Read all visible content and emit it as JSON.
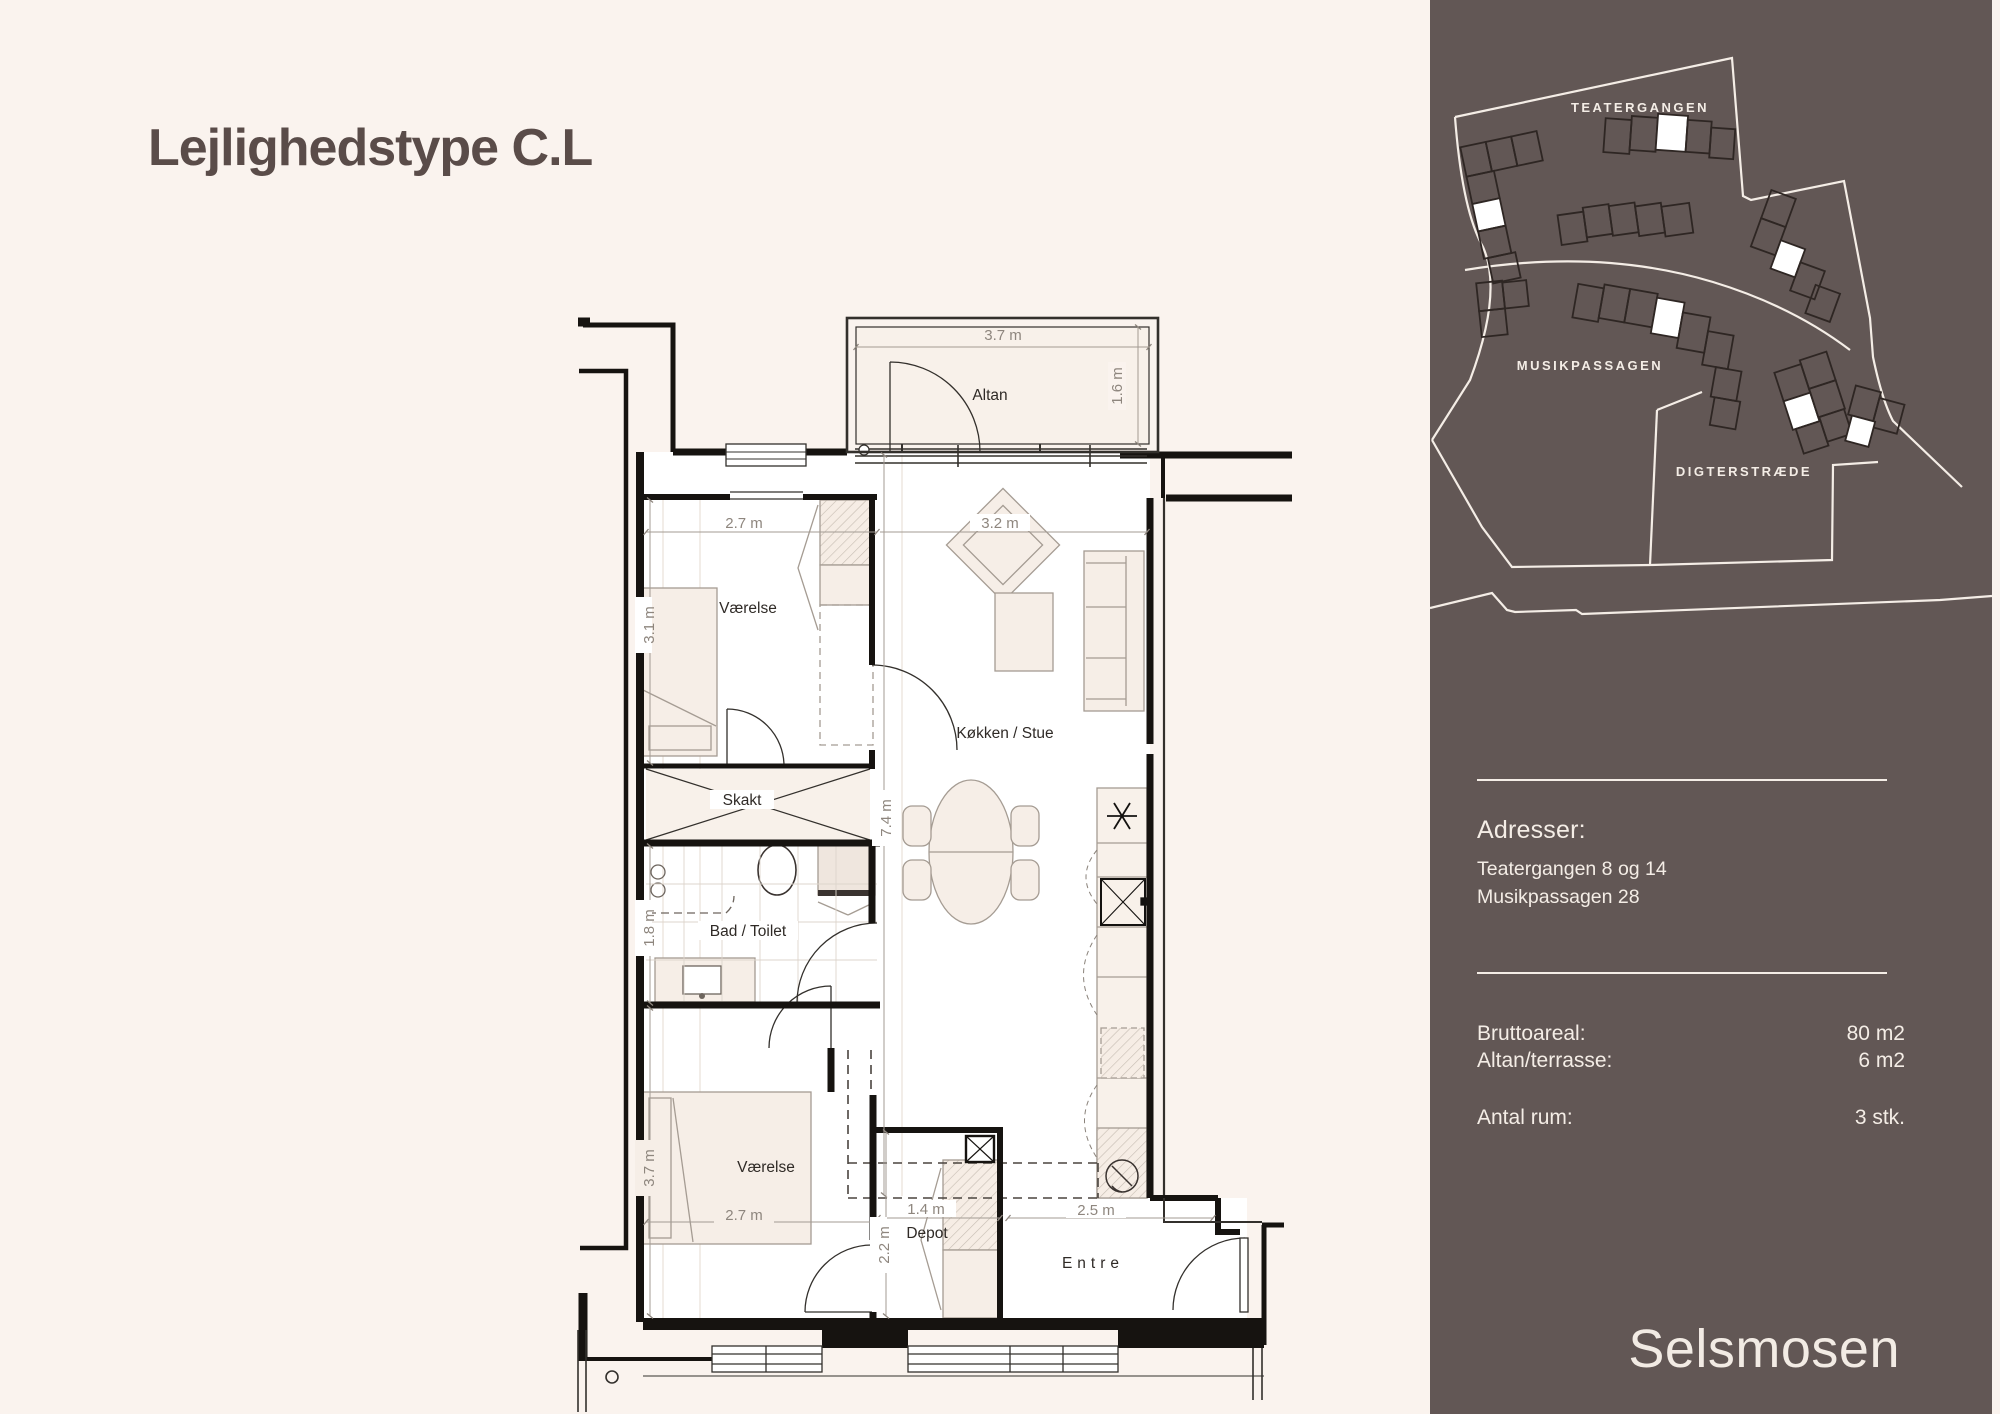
{
  "title": "Lejlighedstype C.L",
  "plan": {
    "rooms": {
      "altan": "Altan",
      "bedroom1": "Værelse",
      "shaft": "Skakt",
      "bath": "Bad / Toilet",
      "living": "Køkken / Stue",
      "bedroom2": "Værelse",
      "storage": "Depot",
      "entry": "Entre"
    },
    "dims": {
      "balcony_width": "3.7 m",
      "balcony_depth": "1.6 m",
      "bedroom1_width": "2.7 m",
      "bedroom1_depth": "3.1 m",
      "living_width": "3.2 m",
      "apartment_depth": "7.4 m",
      "bath_depth": "1.8 m",
      "bedroom2_width": "2.7 m",
      "bedroom2_depth": "3.7 m",
      "storage_width": "1.4 m",
      "storage_depth": "2.2 m",
      "entry_width": "2.5 m"
    }
  },
  "sidebar": {
    "map": {
      "streets": [
        "TEATERGANGEN",
        "MUSIKPASSAGEN",
        "DIGTERSTRÆDE"
      ]
    },
    "address": {
      "heading": "Adresser:",
      "lines": [
        "Teatergangen 8 og 14",
        "Musikpassagen 28"
      ]
    },
    "facts": [
      {
        "label": "Bruttoareal:",
        "value": "80 m2"
      },
      {
        "label": "Altan/terrasse:",
        "value": "6 m2"
      },
      {
        "label": "Antal rum:",
        "value": "3 stk."
      }
    ],
    "brand": "Selsmosen"
  },
  "colors": {
    "background": "#faf3ee",
    "sidebar": "#625755",
    "wall": "#161310",
    "title_text": "#5a4c49",
    "sidebar_text": "#f4ede6"
  }
}
